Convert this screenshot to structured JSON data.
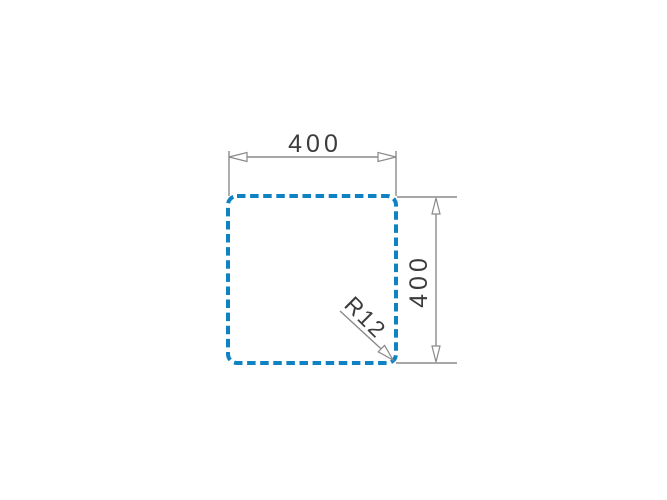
{
  "labels": {
    "width_dimension": "400",
    "height_dimension": "400",
    "corner_radius": "R12"
  },
  "colors": {
    "background": "#ffffff",
    "cutout_dashed_blue": "#0f82c3",
    "dimension_line_gray": "#8a8a8a",
    "text_dark_gray": "#3c3c3c",
    "arrowhead_fill": "#ffffff"
  }
}
